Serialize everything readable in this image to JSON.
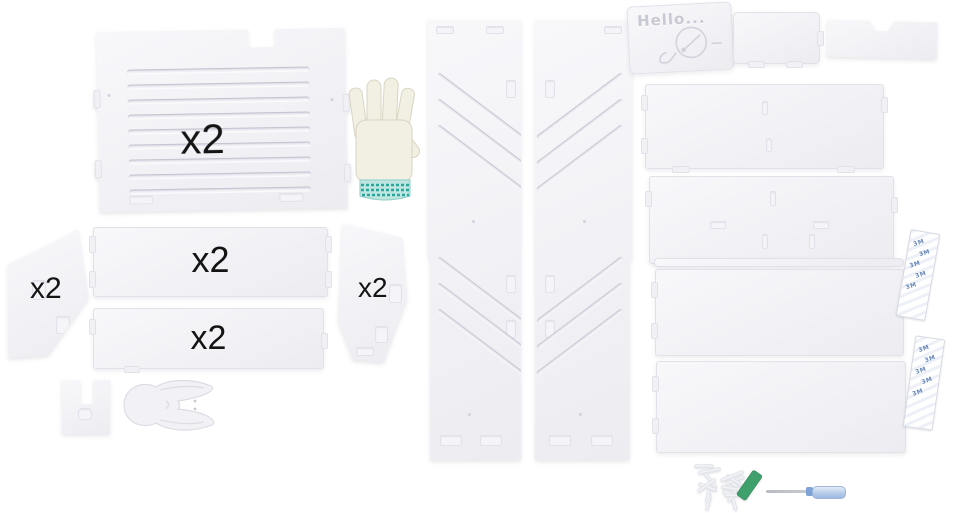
{
  "scene": {
    "type": "product-photo",
    "subject": "DIY plastic storage rack assembly kit parts laid out flat",
    "background": "#ffffff"
  },
  "labels": {
    "slatted_panel_qty": "x2",
    "left_corner_panel_qty": "x2",
    "top_bar_qty": "x2",
    "bottom_bar_qty": "x2",
    "right_corner_panel_qty": "x2",
    "hello_engraving": "Hello...",
    "tape_brand": "3M"
  },
  "parts": [
    {
      "name": "slatted-back-panel"
    },
    {
      "name": "work-glove"
    },
    {
      "name": "left-corner-panel"
    },
    {
      "name": "shelf-bar-top"
    },
    {
      "name": "shelf-bar-bottom"
    },
    {
      "name": "right-corner-panel"
    },
    {
      "name": "u-bracket"
    },
    {
      "name": "rabbit-shaped-piece"
    },
    {
      "name": "tall-side-panel-left"
    },
    {
      "name": "tall-side-panel-right"
    },
    {
      "name": "hello-top-panel"
    },
    {
      "name": "small-panel-with-tabs"
    },
    {
      "name": "small-panel-with-notch"
    },
    {
      "name": "wide-shelf-panel-1"
    },
    {
      "name": "wide-shelf-panel-2"
    },
    {
      "name": "thin-strip"
    },
    {
      "name": "wide-shelf-panel-3"
    },
    {
      "name": "wide-shelf-panel-4"
    },
    {
      "name": "adhesive-strip-1"
    },
    {
      "name": "adhesive-strip-2"
    },
    {
      "name": "screws-pile"
    },
    {
      "name": "green-wrench"
    },
    {
      "name": "screwdriver"
    }
  ],
  "decor": {
    "slat_count": 9,
    "diagonal_grooves_per_group": 3,
    "tape_logo_rows": 5,
    "screw_count": 16
  },
  "colors": {
    "panel_fill": "#f1f1f5",
    "panel_fill_bright": "#f8f8fb",
    "panel_edge": "#e1e1e9",
    "groove_dark": "#dedee7",
    "engraving": "#c9c9d4",
    "label_text": "#141414",
    "glove_body": "#f2f0e3",
    "glove_stroke": "#d9d5c3",
    "glove_cuff": "#2aa79b",
    "tape_blue": "#4f74ad",
    "tool_green": "#3fa06b",
    "screwdriver_handle": "#b7cbe9",
    "screwdriver_band": "#7fa3d6",
    "screwdriver_shaft": "#c6c9cf"
  }
}
